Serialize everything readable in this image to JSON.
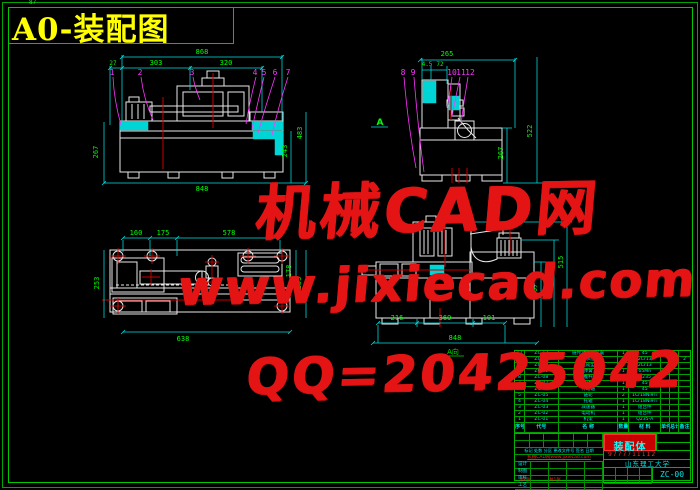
{
  "title": "A0-装配图",
  "frame": {
    "tiny_dim": "87"
  },
  "watermark": {
    "line1": "机械CAD网",
    "line2": "www.jixiecad.com",
    "line3": "QQ=20425042"
  },
  "colors": {
    "background": "#000000",
    "lines": "#e8e8e8",
    "dims": "#00ffff",
    "dim_text": "#00ff00",
    "leaders": "#ff35ff",
    "watermark": "#e51414",
    "title": "#ffff00",
    "frame": "#00b400",
    "highlight": "#00e5e5",
    "center": "#cc0000"
  },
  "views": {
    "front": {
      "dims": {
        "top": "868",
        "d27": "27",
        "d303": "303",
        "d320": "320",
        "left": "267",
        "right_outer": "483",
        "right_inner": "243",
        "bottom": "848"
      },
      "labels": [
        "1",
        "2",
        "3",
        "4",
        "5",
        "6",
        "7"
      ]
    },
    "side": {
      "dims": {
        "top": "265",
        "a": "4.5",
        "b": "72",
        "right_outer": "522",
        "right_inner": "267"
      },
      "labels": [
        "8",
        "9",
        "10",
        "11",
        "12"
      ],
      "section_label": "A"
    },
    "plan": {
      "dims": {
        "a": "160",
        "b": "175",
        "c": "578",
        "left": "253",
        "right_inner": "178",
        "right_outer": "253",
        "bottom": "638"
      }
    },
    "aview": {
      "dims": {
        "a": "216",
        "b": "369",
        "c": "101",
        "total": "848",
        "r1": "307",
        "r2": "416",
        "r3": "515"
      },
      "caption": "A向"
    }
  },
  "bom": {
    "header": [
      "序号",
      "代号",
      "名  称",
      "数量",
      "材 料",
      "单件",
      "总计",
      "备注"
    ],
    "rows": [
      [
        "12",
        "ZC-12",
        "链传动调整装置",
        "1",
        "45",
        "",
        "",
        ""
      ],
      [
        "11",
        "ZC-11",
        "轴承座",
        "2",
        "2Cr13",
        "",
        "",
        "2"
      ],
      [
        "10",
        "ZC-10",
        "压盖成型模",
        "1",
        "2Cr13",
        "",
        "",
        ""
      ],
      [
        "9",
        "ZC-09",
        "弹簧",
        "1",
        "65Mn",
        "",
        "",
        ""
      ],
      [
        "8",
        "ZC-08",
        "推杆",
        "4",
        "Q235",
        "",
        "",
        ""
      ],
      [
        "7",
        "ZC-07",
        "凸轮机构",
        "1",
        "45",
        "",
        "",
        ""
      ],
      [
        "6",
        "ZC-06",
        "传动轴",
        "1",
        "45",
        "",
        "",
        ""
      ],
      [
        "5",
        "ZC-05",
        "链轮",
        "2",
        "1Cr18Ni9Ti",
        "",
        "",
        ""
      ],
      [
        "4",
        "ZC-04",
        "托辊",
        "1",
        "1Cr18Ni9Ti",
        "",
        "",
        ""
      ],
      [
        "3",
        "ZC-03",
        "减速器",
        "1",
        "组合件",
        "",
        "",
        ""
      ],
      [
        "2",
        "ZC-02",
        "电动机",
        "1",
        "组合件",
        "",
        "",
        ""
      ],
      [
        "1",
        "ZC-01",
        "机架",
        "1",
        "Q235-A",
        "",
        "",
        ""
      ]
    ]
  },
  "title_block": {
    "part_name": "装配体",
    "red_number": "9777711112",
    "school": "山东理工大学",
    "drawing_no": "ZC-00",
    "header_line": "标记 处数 分区 更改文件号 签名 日期",
    "red_url": "机械CAD网www.jixiecad.com",
    "left_rows": [
      "设计",
      "制图",
      "审核",
      "工艺"
    ],
    "sheet_1": "第1张",
    "sheet_2": "共1张"
  }
}
